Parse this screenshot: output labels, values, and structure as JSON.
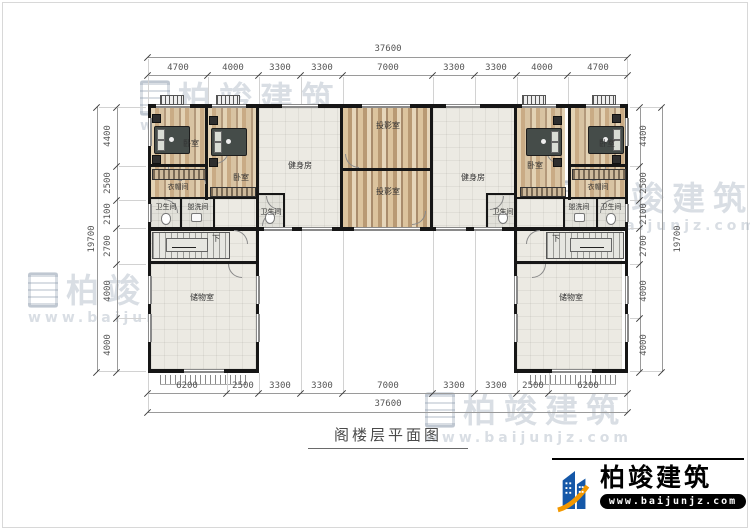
{
  "title": "阁楼层平面图",
  "rooms": {
    "bedroom": "卧室",
    "gym": "健身房",
    "projection": "投影室",
    "cloakroom": "衣帽间",
    "bathroom": "卫生间",
    "washroom": "盥洗间",
    "storage": "储物室",
    "stairs_down": "下"
  },
  "dims": {
    "top": {
      "total": "37600",
      "segments": [
        "4700",
        "4000",
        "3300",
        "3300",
        "7000",
        "3300",
        "3300",
        "4000",
        "4700"
      ]
    },
    "bottom": {
      "total": "37600",
      "segments": [
        "6200",
        "2500",
        "3300",
        "3300",
        "7000",
        "3300",
        "3300",
        "2500",
        "6200"
      ]
    },
    "left": {
      "total": "19700",
      "segments": [
        "4400",
        "2500",
        "2100",
        "2700",
        "4000",
        "4000"
      ]
    },
    "right": {
      "total": "19700",
      "segments": [
        "4400",
        "2500",
        "2100",
        "2700",
        "4000",
        "4000"
      ]
    }
  },
  "logo": {
    "name": "柏竣建筑",
    "url": "www.baijunjz.com"
  },
  "watermark": {
    "name": "柏竣建筑",
    "url": "www.baijunjz.com"
  },
  "colors": {
    "wall": "#161616",
    "wood": "#c9ab85",
    "tile": "#eceae3",
    "dim_text": "#555555",
    "logo_blue": "#1558a8",
    "logo_orange": "#f39800",
    "watermark": "#8291a5"
  }
}
